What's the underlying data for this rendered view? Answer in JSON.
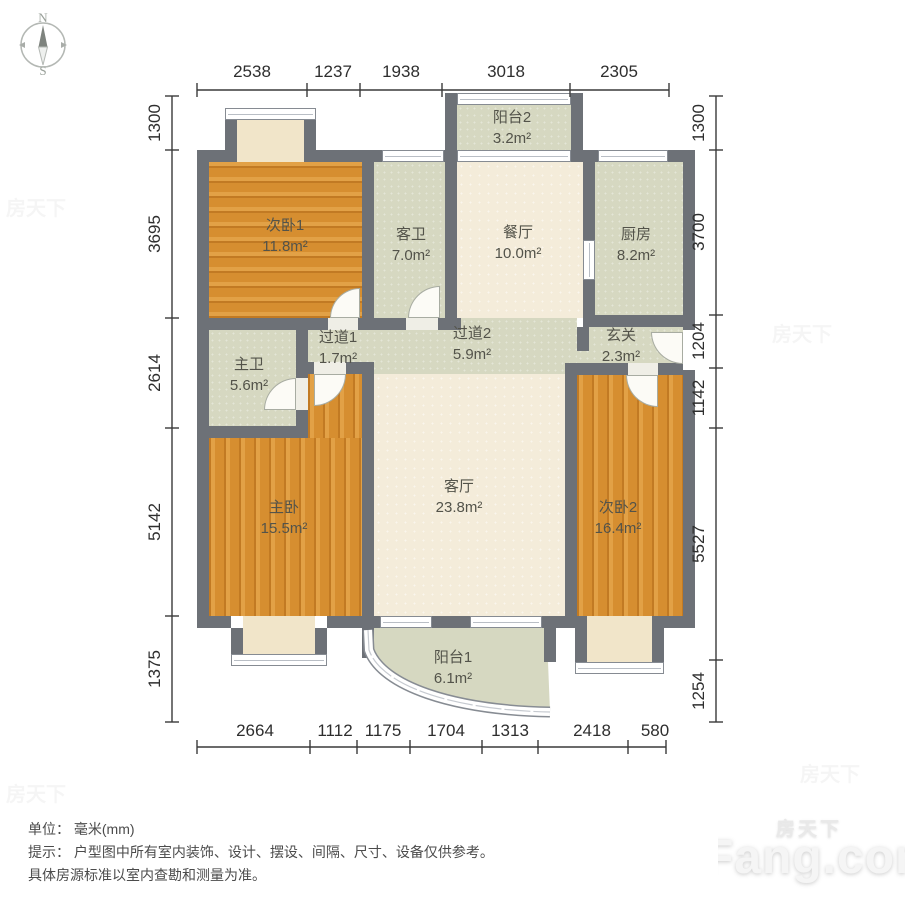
{
  "compass": {
    "north": "N",
    "south": "S"
  },
  "dims": {
    "top": [
      "2538",
      "1237",
      "1938",
      "3018",
      "2305"
    ],
    "left": [
      "1300",
      "3695",
      "2614",
      "5142",
      "1375"
    ],
    "right": [
      "1300",
      "3700",
      "1204",
      "1142",
      "5527",
      "1254"
    ],
    "bottom": [
      "2664",
      "1112",
      "1175",
      "1704",
      "1313",
      "2418",
      "580"
    ]
  },
  "rooms": [
    {
      "name": "次卧1",
      "area": "11.8m²"
    },
    {
      "name": "客卫",
      "area": "7.0m²"
    },
    {
      "name": "餐厅",
      "area": "10.0m²"
    },
    {
      "name": "厨房",
      "area": "8.2m²"
    },
    {
      "name": "阳台2",
      "area": "3.2m²"
    },
    {
      "name": "过道1",
      "area": "1.7m²"
    },
    {
      "name": "过道2",
      "area": "5.9m²"
    },
    {
      "name": "玄关",
      "area": "2.3m²"
    },
    {
      "name": "主卫",
      "area": "5.6m²"
    },
    {
      "name": "主卧",
      "area": "15.5m²"
    },
    {
      "name": "客厅",
      "area": "23.8m²"
    },
    {
      "name": "次卧2",
      "area": "16.4m²"
    },
    {
      "name": "阳台1",
      "area": "6.1m²"
    }
  ],
  "notes": {
    "unit": "单位： 毫米(mm)",
    "tip_line1": "提示： 户型图中所有室内装饰、设计、摆设、间隔、尺寸、设备仅供参考。",
    "tip_line2": "具体房源标准以室内查勘和测量为准。"
  },
  "watermark": {
    "brand_cn": "房天下",
    "brand_en": "Fang.com"
  }
}
